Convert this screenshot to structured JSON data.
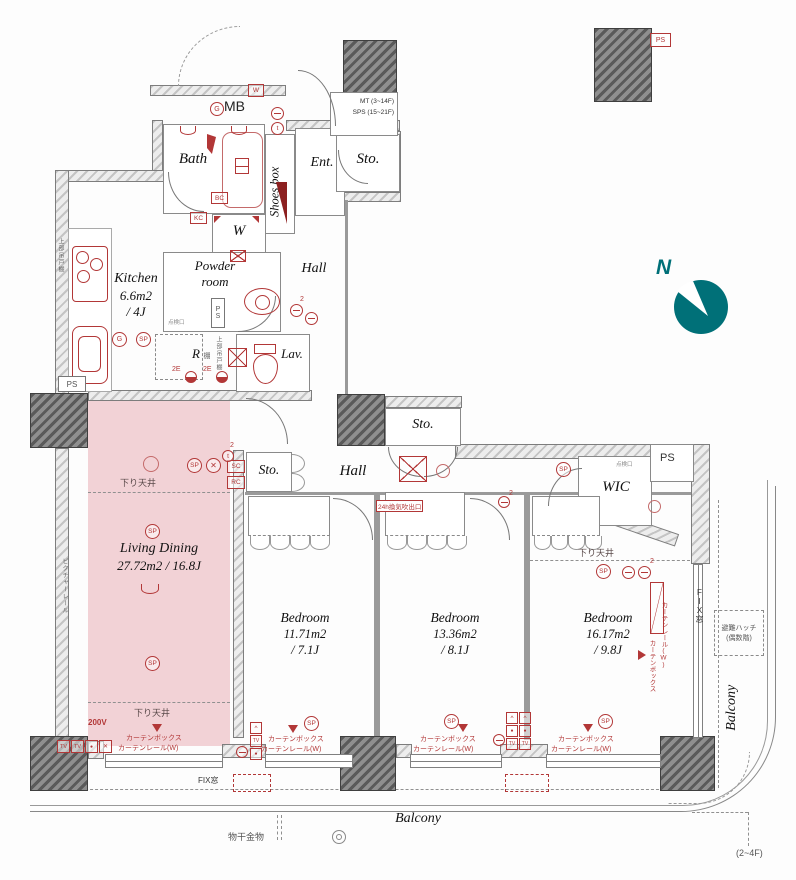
{
  "title": "Apartment floor plan 3LDK",
  "colors": {
    "annotation_red": "#b23737",
    "highlight_pink": "#f0c6ca",
    "compass_teal": "#007078",
    "wall_gray": "#8a8a8a"
  },
  "compass": {
    "label": "N"
  },
  "rooms": {
    "bath": {
      "name": "Bath"
    },
    "mb": {
      "name": "MB"
    },
    "shoes_box": {
      "name": "Shoes box"
    },
    "entrance": {
      "name": "Ent."
    },
    "storage_entry": {
      "name": "Sto."
    },
    "laundry": {
      "name": "W"
    },
    "powder": {
      "line1": "Powder",
      "line2": "room"
    },
    "kitchen": {
      "name": "Kitchen",
      "area": "6.6m2",
      "tatami": "/ 4J"
    },
    "hall_upper": {
      "name": "Hall"
    },
    "refrigerator": {
      "name": "R"
    },
    "lavatory": {
      "name": "Lav."
    },
    "storage_hall_top": {
      "name": "Sto."
    },
    "storage_hall_left": {
      "name": "Sto."
    },
    "hall_middle": {
      "name": "Hall"
    },
    "wic": {
      "name": "WIC"
    },
    "living": {
      "name": "Living Dining",
      "area": "27.72m2 / 16.8J"
    },
    "bedroom1": {
      "name": "Bedroom",
      "area": "11.71m2",
      "tatami": "/ 7.1J"
    },
    "bedroom2": {
      "name": "Bedroom",
      "area": "13.36m2",
      "tatami": "/ 8.1J"
    },
    "bedroom3": {
      "name": "Bedroom",
      "area": "16.17m2",
      "tatami": "/ 9.8J"
    },
    "balcony_bottom": {
      "name": "Balcony"
    },
    "balcony_right": {
      "name": "Balcony"
    }
  },
  "shaft": {
    "line1": "MT (3~14F)",
    "line2": "SPS (15~21F)"
  },
  "labels": {
    "ps": "PS",
    "down_ceiling": "下り天井",
    "curtain_box": "カーテンボックス",
    "curtain_rail": "カーテンレール(W)",
    "picture_rail": "ピクチャーレール",
    "upper_cabinet": "上部吊戸棚",
    "shelf": "棚",
    "inspection_port": "点検口",
    "vent_24h": "24h換気吹出口",
    "fix_window": "FIX窓",
    "power_200v": "200V",
    "laundry_hardware": "物干金物",
    "evac_hatch_line1": "避難ハッチ",
    "evac_hatch_line2": "(偶数階)",
    "floor_range": "(2~4F)"
  },
  "badges": {
    "w": "W",
    "g": "G",
    "sp": "SP",
    "t": "t",
    "bc": "BC",
    "kc": "KC",
    "sc": "SC",
    "rc": "RC",
    "e2": "2E",
    "tv": "TV",
    "two": "2",
    "caret": "^",
    "dot": "●",
    "x": "✕"
  }
}
